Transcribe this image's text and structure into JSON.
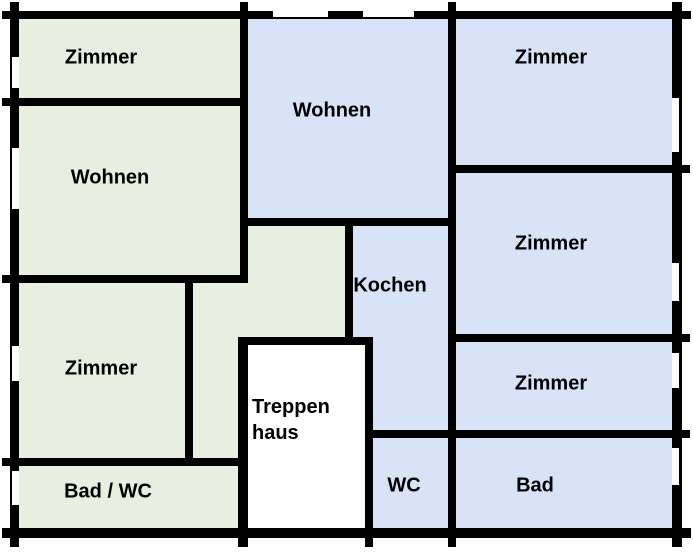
{
  "floorplan": {
    "colors": {
      "apartment_left": "#e8efe1",
      "apartment_right": "#d9e3f7",
      "stairwell": "#ffffff",
      "wall": "#000000"
    },
    "rooms": {
      "zimmer_top_left": {
        "label": "Zimmer"
      },
      "wohnen_left": {
        "label": "Wohnen"
      },
      "zimmer_bottom_left": {
        "label": "Zimmer"
      },
      "bad_wc_left": {
        "label": "Bad / WC"
      },
      "wohnen_center": {
        "label": "Wohnen"
      },
      "kochen": {
        "label": "Kochen"
      },
      "treppenhaus": {
        "label_line1": "Treppen",
        "label_line2": "haus"
      },
      "wc": {
        "label": "WC"
      },
      "bad_right": {
        "label": "Bad"
      },
      "zimmer_top_right": {
        "label": "Zimmer"
      },
      "zimmer_middle_right": {
        "label": "Zimmer"
      },
      "zimmer_lower_right": {
        "label": "Zimmer"
      }
    }
  }
}
